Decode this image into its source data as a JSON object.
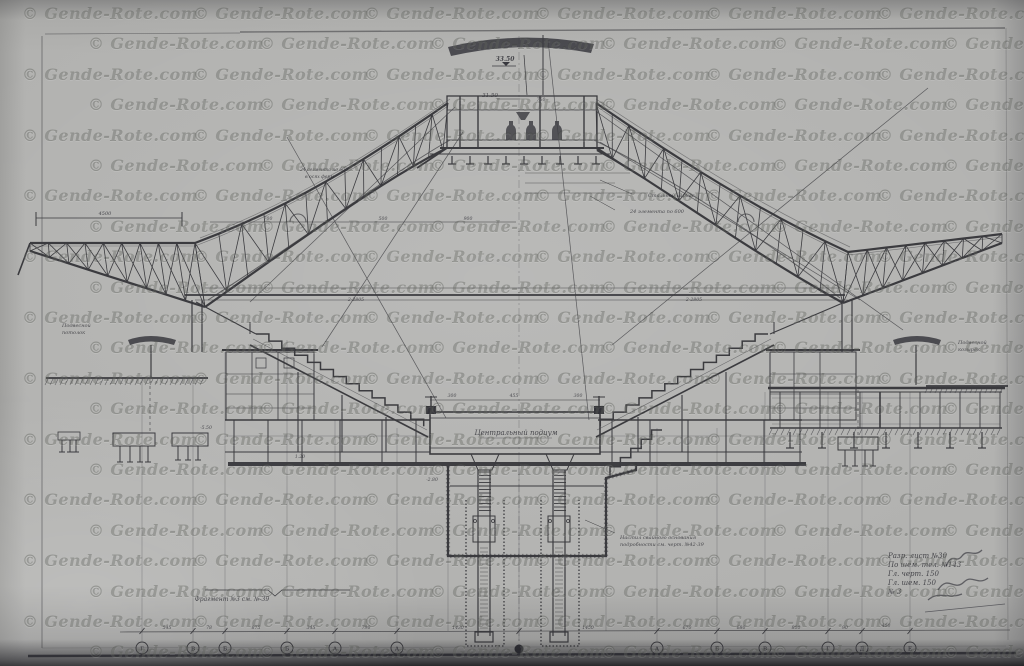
{
  "watermark": {
    "text": "© Gende-Rote.com"
  },
  "title": "Стадион — поперечный разрез (арочное покрытие)",
  "labels": {
    "central_podium": "Центральный подиум",
    "fragment_note": "Фрагмент №3 см. №-39",
    "detail_note_1": "Настил свайного основания",
    "detail_note_2": "подробности см. черт. №42-39",
    "left_ceiling_1": "Подвесной",
    "left_ceiling_2": "потолок",
    "right_canopy_1": "Подвесной",
    "right_canopy_2": "козырёк",
    "roof_note_1": "Стальной каркас",
    "roof_note_2": "24 элемента по 600",
    "truss_note_1": "24 сегмента по 600",
    "truss_note_2": "в осях ферм"
  },
  "elevations": {
    "top": "33.50",
    "lantern": "31.50"
  },
  "dimensions": {
    "left_cantilever": "4500"
  },
  "annotations": [
    {
      "t": "750",
      "x": 541,
      "y": 101
    },
    {
      "t": "700",
      "x": 268,
      "y": 220
    },
    {
      "t": "500",
      "x": 383,
      "y": 220
    },
    {
      "t": "900",
      "x": 468,
      "y": 220
    },
    {
      "t": "300",
      "x": 452,
      "y": 397
    },
    {
      "t": "455",
      "x": 514,
      "y": 397
    },
    {
      "t": "300",
      "x": 578,
      "y": 397
    },
    {
      "t": "2-2805",
      "x": 356,
      "y": 301
    },
    {
      "t": "2-2805",
      "x": 694,
      "y": 301
    },
    {
      "t": "-5.50",
      "x": 206,
      "y": 429
    },
    {
      "t": "-2.80",
      "x": 432,
      "y": 481
    },
    {
      "t": "1.20",
      "x": 300,
      "y": 458
    },
    {
      "t": "545",
      "x": 167,
      "y": 629
    },
    {
      "t": "78",
      "x": 209,
      "y": 629
    },
    {
      "t": "875",
      "x": 256,
      "y": 629
    },
    {
      "t": "345",
      "x": 311,
      "y": 629
    },
    {
      "t": "790",
      "x": 366,
      "y": 629
    },
    {
      "t": "1430",
      "x": 458,
      "y": 629
    },
    {
      "t": "1450",
      "x": 588,
      "y": 629
    },
    {
      "t": "670",
      "x": 687,
      "y": 629
    },
    {
      "t": "680",
      "x": 741,
      "y": 629
    },
    {
      "t": "800",
      "x": 796,
      "y": 629
    },
    {
      "t": "90",
      "x": 845,
      "y": 629
    },
    {
      "t": "400",
      "x": 886,
      "y": 627
    }
  ],
  "axes": {
    "labels": [
      "Г",
      "В",
      "Б",
      "Б",
      "А",
      "А",
      "",
      "А",
      "Б",
      "В",
      "Г",
      "Д",
      "Е"
    ]
  },
  "handwriting": {
    "lines": [
      "Разр. лист №30",
      "По шем. тел. №143",
      "Гл. черт. 150",
      "Гл. шем. 150",
      "№ 3"
    ]
  }
}
